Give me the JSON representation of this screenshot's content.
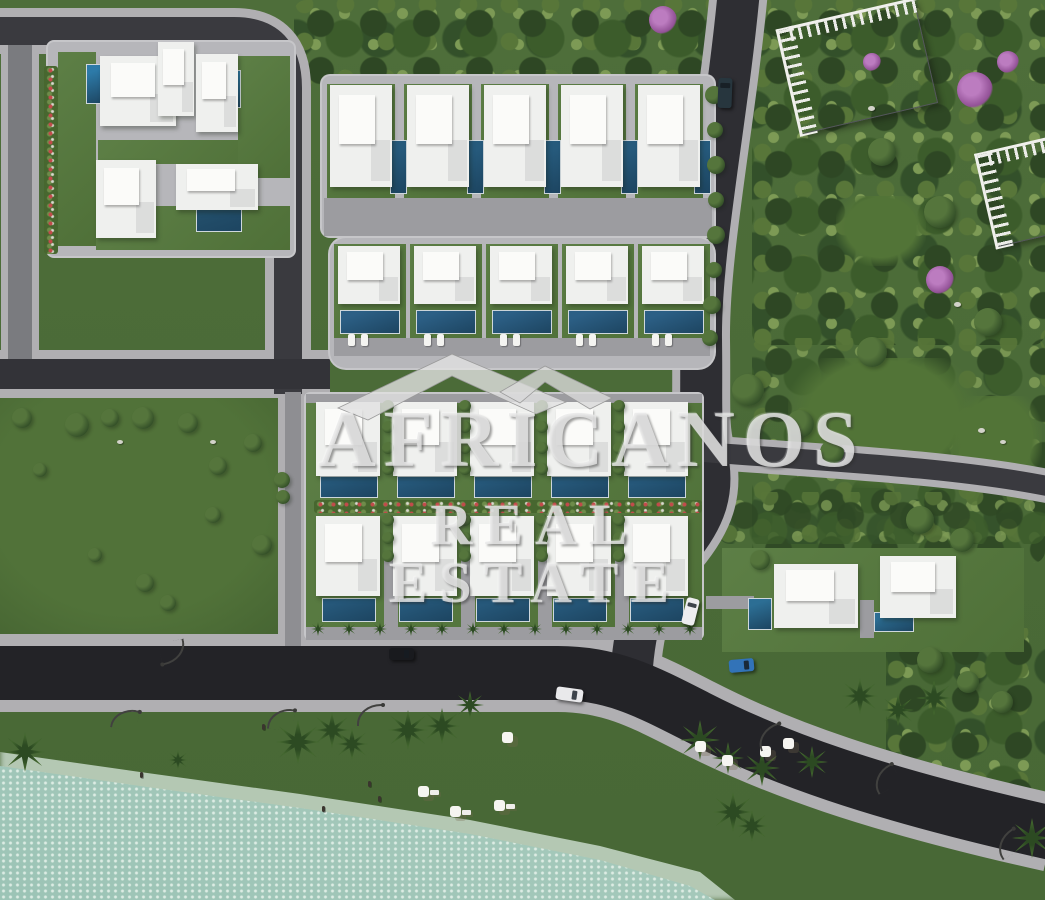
{
  "watermark": {
    "line1": "AFRICANOS",
    "line2": "REAL ESTATE",
    "logo": "house-roof-icon",
    "color": "#e8e8e8"
  },
  "palette": {
    "grass": "#4a6a37",
    "park_tree_dark": "#2e4724",
    "park_tree_light": "#7d9a55",
    "asphalt": "#2c2c30",
    "coastal_asphalt": "#232327",
    "sidewalk": "#b0afb2",
    "concrete_road": "#8e8e92",
    "pad": "#b6b6ba",
    "villa": "#eff0ee",
    "pool_bright": "#2d7aa8",
    "pool_deep": "#265a7c",
    "sand": "#e9d9bd",
    "water": "#b7d4c7",
    "foam": "#d9e8de",
    "purple_tree": "#925196",
    "car_blue": "#3273b8"
  },
  "scene": {
    "field": {
      "x": 0,
      "y": 396,
      "w": 308,
      "h": 252
    },
    "forests": [
      {
        "x": 294,
        "y": 0,
        "w": 434,
        "h": 86,
        "op": 1
      },
      {
        "x": 752,
        "y": 0,
        "w": 293,
        "h": 345,
        "op": 1
      },
      {
        "x": 752,
        "y": 338,
        "w": 293,
        "h": 225,
        "op": 0.9
      },
      {
        "x": 886,
        "y": 628,
        "w": 159,
        "h": 168,
        "op": 1
      },
      {
        "x": 718,
        "y": 492,
        "w": 327,
        "h": 52,
        "op": 0.8
      }
    ],
    "clearings": [
      {
        "x": 788,
        "y": 358,
        "w": 190,
        "h": 130
      },
      {
        "x": 952,
        "y": 396,
        "w": 90,
        "h": 95
      },
      {
        "x": 836,
        "y": 196,
        "w": 90,
        "h": 70
      }
    ],
    "sand_clip": "polygon(0px 640px,556px 640px,596px 652px,648px 670px,702px 694px,788px 732px,884px 770px,1002px 812px,1045px 826px,1045px 900px,0px 900px)",
    "foam_clip": "polygon(0px 752px,140px 772px,300px 794px,470px 820px,600px 846px,700px 872px,735px 900px,0px 900px)",
    "water_clip": "polygon(0px 766px,140px 786px,300px 808px,470px 834px,600px 860px,690px 886px,715px 900px,0px 900px)",
    "roads": {
      "casing_color": "#b0afb2",
      "segments": [
        {
          "name": "left-street",
          "d": "M20 28 L20 372",
          "cw": 38,
          "w": 24,
          "color": "#7a7b7f"
        },
        {
          "name": "top-street",
          "d": "M-8 31 L234 31 Q288 31 288 88 L288 394",
          "cw": 46,
          "w": 28,
          "color": "#3a3a3f"
        },
        {
          "name": "middle-street",
          "d": "M-8 374 L330 374",
          "cw": 48,
          "w": 30,
          "color": "#333338"
        },
        {
          "name": "block-access-road",
          "d": "M293 392 L293 658",
          "cw": 30,
          "w": 16,
          "color": "#8e8e92"
        },
        {
          "name": "main-avenue",
          "d": "M739 -10 C727 120 700 250 701 340 C702 405 699 425 706 452 C716 492 704 520 678 551 C652 582 637 607 632 666",
          "cw": 58,
          "w": 42,
          "color": "#2e2e33"
        },
        {
          "name": "branch-road",
          "d": "M704 452 C800 460 950 466 1052 487",
          "cw": 34,
          "w": 20,
          "color": "#3a3a3f"
        },
        {
          "name": "coastal-road",
          "d": "M-8 673 L558 673 C612 673 646 691 697 717 C775 757 873 793 1052 833",
          "cw": 78,
          "w": 54,
          "color": "#232327"
        }
      ]
    },
    "pads": [
      {
        "x": 48,
        "y": 42,
        "w": 246,
        "h": 214,
        "r": 6
      },
      {
        "x": 322,
        "y": 76,
        "w": 392,
        "h": 160,
        "r": 8
      },
      {
        "x": 330,
        "y": 238,
        "w": 384,
        "h": 130,
        "r": 16
      },
      {
        "x": 306,
        "y": 394,
        "w": 396,
        "h": 244,
        "r": 4
      }
    ],
    "gardens": [
      {
        "x": 58,
        "y": 52,
        "w": 38,
        "h": 194
      },
      {
        "x": 98,
        "y": 140,
        "w": 190,
        "h": 24
      },
      {
        "x": 238,
        "y": 56,
        "w": 52,
        "h": 122
      },
      {
        "x": 96,
        "y": 206,
        "w": 194,
        "h": 44
      },
      {
        "x": 327,
        "y": 84,
        "w": 68,
        "h": 120
      },
      {
        "x": 404,
        "y": 84,
        "w": 68,
        "h": 120
      },
      {
        "x": 481,
        "y": 84,
        "w": 68,
        "h": 120
      },
      {
        "x": 558,
        "y": 84,
        "w": 68,
        "h": 120
      },
      {
        "x": 635,
        "y": 84,
        "w": 68,
        "h": 120
      },
      {
        "x": 334,
        "y": 244,
        "w": 72,
        "h": 112
      },
      {
        "x": 410,
        "y": 244,
        "w": 72,
        "h": 112
      },
      {
        "x": 486,
        "y": 244,
        "w": 72,
        "h": 112
      },
      {
        "x": 562,
        "y": 244,
        "w": 72,
        "h": 112
      },
      {
        "x": 638,
        "y": 244,
        "w": 72,
        "h": 112
      },
      {
        "x": 306,
        "y": 396,
        "w": 396,
        "h": 238
      },
      {
        "x": 722,
        "y": 548,
        "w": 302,
        "h": 104
      }
    ],
    "driveways": [
      {
        "x": 324,
        "y": 198,
        "w": 388,
        "h": 38
      },
      {
        "x": 334,
        "y": 338,
        "w": 376,
        "h": 18
      },
      {
        "x": 306,
        "y": 394,
        "w": 396,
        "h": 9
      },
      {
        "x": 306,
        "y": 627,
        "w": 396,
        "h": 13
      },
      {
        "x": 384,
        "y": 558,
        "w": 14,
        "h": 70
      },
      {
        "x": 461,
        "y": 558,
        "w": 14,
        "h": 70
      },
      {
        "x": 538,
        "y": 558,
        "w": 14,
        "h": 70
      },
      {
        "x": 615,
        "y": 558,
        "w": 14,
        "h": 70
      },
      {
        "x": 706,
        "y": 596,
        "w": 48,
        "h": 13
      },
      {
        "x": 860,
        "y": 600,
        "w": 14,
        "h": 38
      }
    ],
    "flower_hedges": [
      {
        "x": 314,
        "y": 500,
        "w": 388,
        "h": 13
      },
      {
        "x": 44,
        "y": 66,
        "w": 14,
        "h": 188
      }
    ],
    "villas": [
      {
        "x": 100,
        "y": 56,
        "w": 76,
        "h": 70
      },
      {
        "x": 158,
        "y": 42,
        "w": 36,
        "h": 74
      },
      {
        "x": 196,
        "y": 54,
        "w": 42,
        "h": 78
      },
      {
        "x": 96,
        "y": 160,
        "w": 60,
        "h": 78
      },
      {
        "x": 176,
        "y": 164,
        "w": 82,
        "h": 46
      },
      {
        "x": 330,
        "y": 85,
        "w": 62,
        "h": 102
      },
      {
        "x": 407,
        "y": 85,
        "w": 62,
        "h": 102
      },
      {
        "x": 484,
        "y": 85,
        "w": 62,
        "h": 102
      },
      {
        "x": 561,
        "y": 85,
        "w": 62,
        "h": 102
      },
      {
        "x": 638,
        "y": 85,
        "w": 62,
        "h": 102
      },
      {
        "x": 338,
        "y": 246,
        "w": 62,
        "h": 58
      },
      {
        "x": 414,
        "y": 246,
        "w": 62,
        "h": 58
      },
      {
        "x": 490,
        "y": 246,
        "w": 62,
        "h": 58
      },
      {
        "x": 566,
        "y": 246,
        "w": 62,
        "h": 58
      },
      {
        "x": 642,
        "y": 246,
        "w": 62,
        "h": 58
      },
      {
        "x": 316,
        "y": 402,
        "w": 64,
        "h": 74
      },
      {
        "x": 393,
        "y": 402,
        "w": 64,
        "h": 74
      },
      {
        "x": 470,
        "y": 402,
        "w": 64,
        "h": 74
      },
      {
        "x": 547,
        "y": 402,
        "w": 64,
        "h": 74
      },
      {
        "x": 624,
        "y": 402,
        "w": 64,
        "h": 74
      },
      {
        "x": 316,
        "y": 516,
        "w": 64,
        "h": 80
      },
      {
        "x": 393,
        "y": 516,
        "w": 64,
        "h": 80
      },
      {
        "x": 470,
        "y": 516,
        "w": 64,
        "h": 80
      },
      {
        "x": 547,
        "y": 516,
        "w": 64,
        "h": 80
      },
      {
        "x": 624,
        "y": 516,
        "w": 64,
        "h": 80
      },
      {
        "x": 774,
        "y": 564,
        "w": 84,
        "h": 64
      },
      {
        "x": 880,
        "y": 556,
        "w": 76,
        "h": 62
      }
    ],
    "pools": [
      {
        "x": 86,
        "y": 64,
        "w": 17,
        "h": 38,
        "c": "#2d7aa8"
      },
      {
        "x": 219,
        "y": 70,
        "w": 20,
        "h": 36,
        "c": "#2d7aa8"
      },
      {
        "x": 196,
        "y": 206,
        "w": 44,
        "h": 24,
        "c": "#234f6b"
      },
      {
        "x": 390,
        "y": 140,
        "w": 15,
        "h": 52,
        "c": "#265a7c"
      },
      {
        "x": 467,
        "y": 140,
        "w": 15,
        "h": 52,
        "c": "#265a7c"
      },
      {
        "x": 544,
        "y": 140,
        "w": 15,
        "h": 52,
        "c": "#265a7c"
      },
      {
        "x": 621,
        "y": 140,
        "w": 15,
        "h": 52,
        "c": "#265a7c"
      },
      {
        "x": 694,
        "y": 140,
        "w": 15,
        "h": 52,
        "c": "#265a7c"
      },
      {
        "x": 340,
        "y": 310,
        "w": 58,
        "h": 22,
        "c": "#2c5f85"
      },
      {
        "x": 416,
        "y": 310,
        "w": 58,
        "h": 22,
        "c": "#2c5f85"
      },
      {
        "x": 492,
        "y": 310,
        "w": 58,
        "h": 22,
        "c": "#2c5f85"
      },
      {
        "x": 568,
        "y": 310,
        "w": 58,
        "h": 22,
        "c": "#2c5f85"
      },
      {
        "x": 644,
        "y": 310,
        "w": 58,
        "h": 22,
        "c": "#2c5f85"
      },
      {
        "x": 320,
        "y": 476,
        "w": 56,
        "h": 20,
        "c": "#26587a"
      },
      {
        "x": 397,
        "y": 476,
        "w": 56,
        "h": 20,
        "c": "#26587a"
      },
      {
        "x": 474,
        "y": 476,
        "w": 56,
        "h": 20,
        "c": "#26587a"
      },
      {
        "x": 551,
        "y": 476,
        "w": 56,
        "h": 20,
        "c": "#26587a"
      },
      {
        "x": 628,
        "y": 476,
        "w": 56,
        "h": 20,
        "c": "#26587a"
      },
      {
        "x": 322,
        "y": 598,
        "w": 52,
        "h": 22,
        "c": "#26587a"
      },
      {
        "x": 399,
        "y": 598,
        "w": 52,
        "h": 22,
        "c": "#26587a"
      },
      {
        "x": 476,
        "y": 598,
        "w": 52,
        "h": 22,
        "c": "#26587a"
      },
      {
        "x": 553,
        "y": 598,
        "w": 52,
        "h": 22,
        "c": "#26587a"
      },
      {
        "x": 630,
        "y": 598,
        "w": 52,
        "h": 22,
        "c": "#26587a"
      },
      {
        "x": 748,
        "y": 598,
        "w": 22,
        "h": 30,
        "c": "#2c6e94"
      },
      {
        "x": 874,
        "y": 612,
        "w": 38,
        "h": 18,
        "c": "#2c6e94"
      }
    ],
    "loungers": {
      "y": 334,
      "xs": [
        348,
        361,
        424,
        437,
        500,
        513,
        576,
        589,
        652,
        665
      ]
    },
    "vlines": [
      {
        "x": 388,
        "y0": 406,
        "y1": 470,
        "step": 21,
        "r": 6
      },
      {
        "x": 465,
        "y0": 406,
        "y1": 470,
        "step": 21,
        "r": 6
      },
      {
        "x": 542,
        "y0": 406,
        "y1": 470,
        "step": 21,
        "r": 6
      },
      {
        "x": 619,
        "y0": 406,
        "y1": 470,
        "step": 21,
        "r": 6
      },
      {
        "x": 388,
        "y0": 520,
        "y1": 556,
        "step": 18,
        "r": 6
      },
      {
        "x": 465,
        "y0": 520,
        "y1": 556,
        "step": 18,
        "r": 6
      },
      {
        "x": 542,
        "y0": 520,
        "y1": 556,
        "step": 18,
        "r": 6
      },
      {
        "x": 619,
        "y0": 520,
        "y1": 556,
        "step": 18,
        "r": 6
      }
    ],
    "palm_row": {
      "y": 629,
      "x0": 318,
      "x1": 692,
      "step": 31,
      "r": 7
    },
    "bushes": [
      [
        22,
        418,
        10
      ],
      [
        77,
        425,
        12
      ],
      [
        110,
        418,
        9
      ],
      [
        143,
        418,
        11
      ],
      [
        188,
        423,
        10
      ],
      [
        218,
        466,
        9
      ],
      [
        213,
        515,
        8
      ],
      [
        262,
        545,
        10
      ],
      [
        145,
        583,
        9
      ],
      [
        168,
        603,
        8
      ],
      [
        253,
        443,
        9
      ],
      [
        282,
        480,
        8
      ],
      [
        283,
        497,
        7
      ],
      [
        40,
        470,
        7
      ],
      [
        95,
        555,
        7
      ],
      [
        714,
        95,
        9
      ],
      [
        715,
        130,
        8
      ],
      [
        716,
        165,
        9
      ],
      [
        716,
        200,
        8
      ],
      [
        716,
        235,
        9
      ],
      [
        714,
        270,
        8
      ],
      [
        712,
        305,
        9
      ],
      [
        710,
        338,
        8
      ],
      [
        748,
        390,
        16
      ],
      [
        800,
        424,
        14
      ],
      [
        832,
        452,
        12
      ],
      [
        920,
        520,
        14
      ],
      [
        962,
        540,
        12
      ],
      [
        872,
        352,
        15
      ],
      [
        988,
        322,
        14
      ],
      [
        940,
        212,
        16
      ],
      [
        882,
        152,
        14
      ],
      [
        930,
        660,
        13
      ],
      [
        968,
        682,
        11
      ],
      [
        1002,
        702,
        11
      ],
      [
        760,
        560,
        10
      ]
    ],
    "purple_trees": [
      [
        663,
        20,
        14
      ],
      [
        975,
        90,
        18
      ],
      [
        1008,
        62,
        11
      ],
      [
        940,
        280,
        14
      ],
      [
        872,
        62,
        9
      ]
    ],
    "stones": [
      [
        117,
        440,
        4
      ],
      [
        210,
        440,
        4
      ],
      [
        954,
        302,
        5
      ],
      [
        978,
        428,
        5
      ],
      [
        1000,
        440,
        4
      ],
      [
        868,
        106,
        5
      ]
    ],
    "palms": [
      [
        25,
        752,
        20
      ],
      [
        298,
        742,
        22
      ],
      [
        332,
        730,
        18
      ],
      [
        352,
        744,
        16
      ],
      [
        408,
        730,
        20
      ],
      [
        442,
        726,
        18
      ],
      [
        470,
        705,
        14
      ],
      [
        700,
        740,
        20
      ],
      [
        728,
        758,
        16
      ],
      [
        762,
        768,
        18
      ],
      [
        812,
        762,
        16
      ],
      [
        733,
        812,
        20
      ],
      [
        752,
        826,
        16
      ],
      [
        860,
        696,
        18
      ],
      [
        898,
        710,
        16
      ],
      [
        934,
        698,
        18
      ],
      [
        1032,
        838,
        20
      ],
      [
        178,
        760,
        10
      ]
    ],
    "umbrellas": [
      [
        418,
        786
      ],
      [
        450,
        806
      ],
      [
        494,
        800
      ],
      [
        502,
        732
      ],
      [
        695,
        741
      ],
      [
        722,
        755
      ],
      [
        760,
        746
      ],
      [
        783,
        738
      ]
    ],
    "sunbeds": [
      [
        430,
        790
      ],
      [
        462,
        810
      ],
      [
        506,
        804
      ]
    ],
    "lamps": [
      {
        "x": 112,
        "y": 708,
        "rot": 12
      },
      {
        "x": 268,
        "y": 708,
        "rot": 6
      },
      {
        "x": 357,
        "y": 704,
        "rot": 0
      },
      {
        "x": 757,
        "y": 726,
        "rot": -18
      },
      {
        "x": 872,
        "y": 768,
        "rot": -28
      },
      {
        "x": 160,
        "y": 641,
        "rot": 168
      },
      {
        "x": 995,
        "y": 833,
        "rot": -32
      }
    ],
    "people": [
      [
        368,
        781
      ],
      [
        378,
        796
      ],
      [
        322,
        806
      ],
      [
        262,
        724
      ],
      [
        140,
        772
      ]
    ],
    "cars": [
      {
        "x": 718,
        "y": 78,
        "w": 14,
        "h": 30,
        "c": "#27363e",
        "rot": 2
      },
      {
        "x": 389,
        "y": 648,
        "w": 25,
        "h": 12,
        "c": "#191a1e",
        "rot": 0
      },
      {
        "x": 556,
        "y": 688,
        "w": 27,
        "h": 13,
        "c": "#e9e9eb",
        "rot": 8
      },
      {
        "x": 729,
        "y": 659,
        "w": 25,
        "h": 13,
        "c": "#3273b8",
        "rot": -5
      },
      {
        "x": 684,
        "y": 598,
        "w": 13,
        "h": 27,
        "c": "#ededef",
        "rot": 14
      }
    ],
    "thatched_buildings": [
      {
        "x": 788,
        "y": 14,
        "w": 138,
        "h": 104,
        "rot": -13
      },
      {
        "x": 986,
        "y": 146,
        "w": 72,
        "h": 92,
        "rot": -13
      }
    ]
  }
}
